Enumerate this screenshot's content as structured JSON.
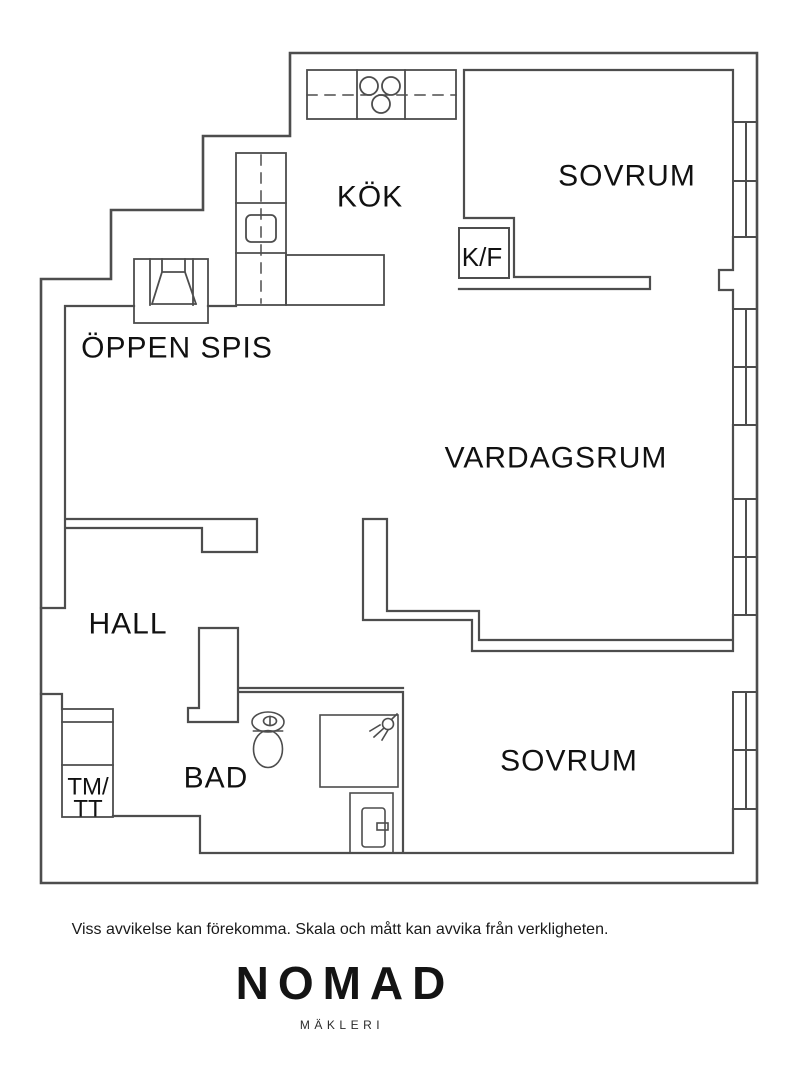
{
  "floorplan": {
    "rooms": {
      "kok": {
        "label": "KÖK"
      },
      "sovrum_top": {
        "label": "SOVRUM"
      },
      "vardagsrum": {
        "label": "VARDAGSRUM"
      },
      "oppen_spis": {
        "label": "ÖPPEN SPIS"
      },
      "hall": {
        "label": "HALL"
      },
      "bad": {
        "label": "BAD"
      },
      "sovrum_bottom": {
        "label": "SOVRUM"
      },
      "kf": {
        "label": "K/F"
      },
      "tmtt": {
        "line1": "TM/",
        "line2": "TT"
      }
    },
    "colors": {
      "wall": "#4d4d4d",
      "text": "#111111",
      "background": "#ffffff"
    }
  },
  "footer": {
    "disclaimer": "Viss avvikelse kan förekomma. Skala och mått kan avvika från verkligheten.",
    "brand": "NOMAD",
    "brand_sub": "MÄKLERI"
  }
}
